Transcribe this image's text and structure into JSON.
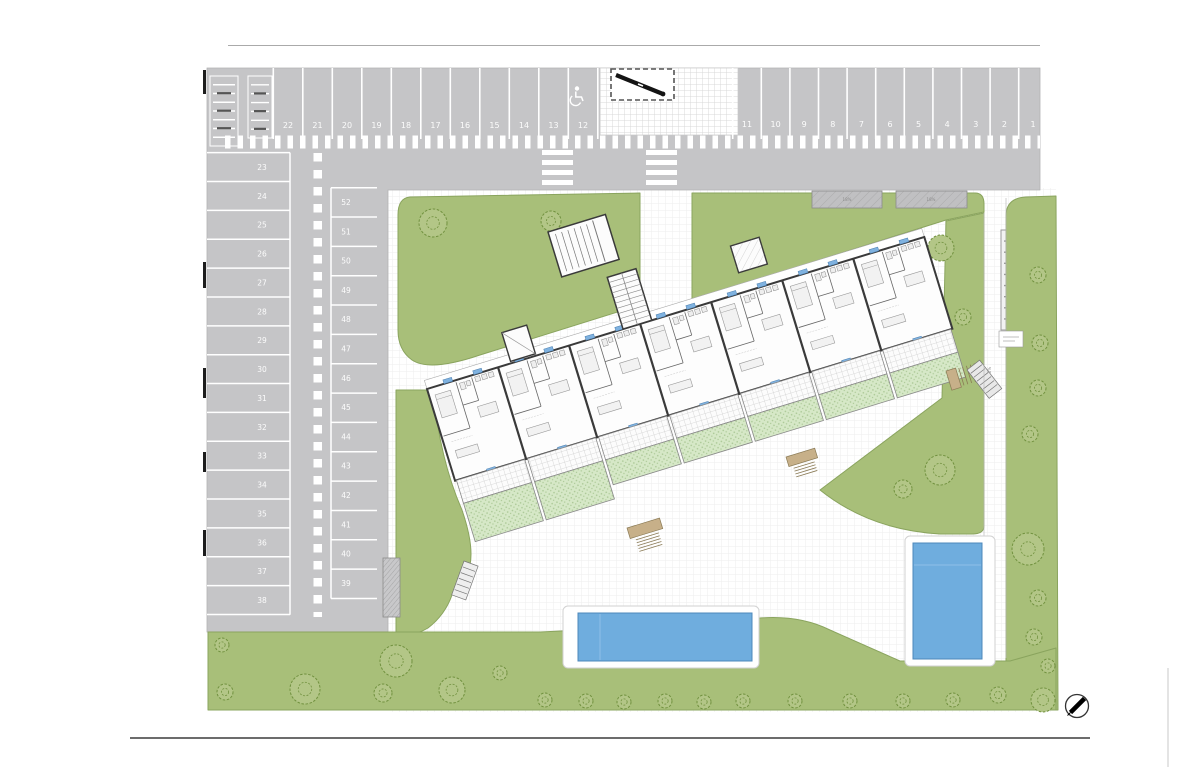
{
  "document": {
    "type": "residential-site-plan-drawing",
    "compass_needle_direction": "north-east"
  },
  "colors": {
    "asphalt": "#c5c5c7",
    "marking": "#ffffff",
    "lawn": "#a8bf79",
    "lawn_edge": "#8aa45e",
    "tree_stroke": "#71913f",
    "tree_fill": "#b3c687",
    "terrace_garden": "#d6e8c7",
    "garden_dot": "#abc896",
    "pool_water": "#6fadde",
    "pool_edge": "#4e88bb",
    "building_wall": "#3a3a3a",
    "window_tag": "#7fb2e0",
    "steps_wood": "#c7b089",
    "boundary_line": "#3c3c3c"
  },
  "parking": {
    "top_row_left": {
      "spaces": [
        "22",
        "21",
        "20",
        "19",
        "18",
        "17",
        "16",
        "15",
        "14",
        "13",
        "12"
      ],
      "accessible_space": "12"
    },
    "top_row_right": {
      "spaces": [
        "11",
        "10",
        "9",
        "8",
        "7",
        "6",
        "5",
        "4",
        "3",
        "2",
        "1"
      ]
    },
    "west_outer_column": {
      "spaces": [
        "23",
        "24",
        "25",
        "26",
        "27",
        "28",
        "29",
        "30",
        "31",
        "32",
        "33",
        "34",
        "35",
        "36",
        "37",
        "38"
      ]
    },
    "west_inner_column": {
      "spaces": [
        "52",
        "51",
        "50",
        "49",
        "48",
        "47",
        "46",
        "45",
        "44",
        "43",
        "42",
        "41",
        "40",
        "39"
      ]
    },
    "total_spaces": 52
  },
  "labels": {
    "ramp_grade": "18%",
    "path_grade": "6%"
  },
  "building": {
    "units": 7,
    "window_tags_per_unit": 3
  },
  "pools": [
    {
      "name": "main-pool",
      "orientation": "horizontal"
    },
    {
      "name": "small-pool",
      "orientation": "vertical"
    }
  ],
  "icons": [
    {
      "name": "accessible-parking-icon"
    },
    {
      "name": "north-compass-icon"
    },
    {
      "name": "bike-rack-icon"
    },
    {
      "name": "gate-barrier-icon"
    }
  ],
  "trees": [
    {
      "x": 433,
      "y": 223,
      "r": 14
    },
    {
      "x": 551,
      "y": 221,
      "r": 10
    },
    {
      "x": 941,
      "y": 248,
      "r": 13
    },
    {
      "x": 963,
      "y": 317,
      "r": 8
    },
    {
      "x": 1038,
      "y": 275,
      "r": 8
    },
    {
      "x": 1040,
      "y": 343,
      "r": 8
    },
    {
      "x": 1038,
      "y": 388,
      "r": 8
    },
    {
      "x": 1030,
      "y": 434,
      "r": 8
    },
    {
      "x": 940,
      "y": 470,
      "r": 15
    },
    {
      "x": 903,
      "y": 489,
      "r": 9
    },
    {
      "x": 1028,
      "y": 549,
      "r": 16
    },
    {
      "x": 1038,
      "y": 598,
      "r": 8
    },
    {
      "x": 1034,
      "y": 637,
      "r": 8
    },
    {
      "x": 222,
      "y": 645,
      "r": 7
    },
    {
      "x": 225,
      "y": 692,
      "r": 8
    },
    {
      "x": 305,
      "y": 689,
      "r": 15
    },
    {
      "x": 396,
      "y": 661,
      "r": 16
    },
    {
      "x": 383,
      "y": 693,
      "r": 9
    },
    {
      "x": 452,
      "y": 690,
      "r": 13
    },
    {
      "x": 500,
      "y": 673,
      "r": 7
    },
    {
      "x": 545,
      "y": 700,
      "r": 7
    },
    {
      "x": 586,
      "y": 701,
      "r": 7
    },
    {
      "x": 624,
      "y": 702,
      "r": 7
    },
    {
      "x": 665,
      "y": 701,
      "r": 7
    },
    {
      "x": 704,
      "y": 702,
      "r": 7
    },
    {
      "x": 743,
      "y": 701,
      "r": 7
    },
    {
      "x": 795,
      "y": 701,
      "r": 7
    },
    {
      "x": 850,
      "y": 701,
      "r": 7
    },
    {
      "x": 903,
      "y": 701,
      "r": 7
    },
    {
      "x": 953,
      "y": 700,
      "r": 7
    },
    {
      "x": 998,
      "y": 695,
      "r": 8
    },
    {
      "x": 1043,
      "y": 700,
      "r": 12
    },
    {
      "x": 1048,
      "y": 666,
      "r": 7
    }
  ]
}
